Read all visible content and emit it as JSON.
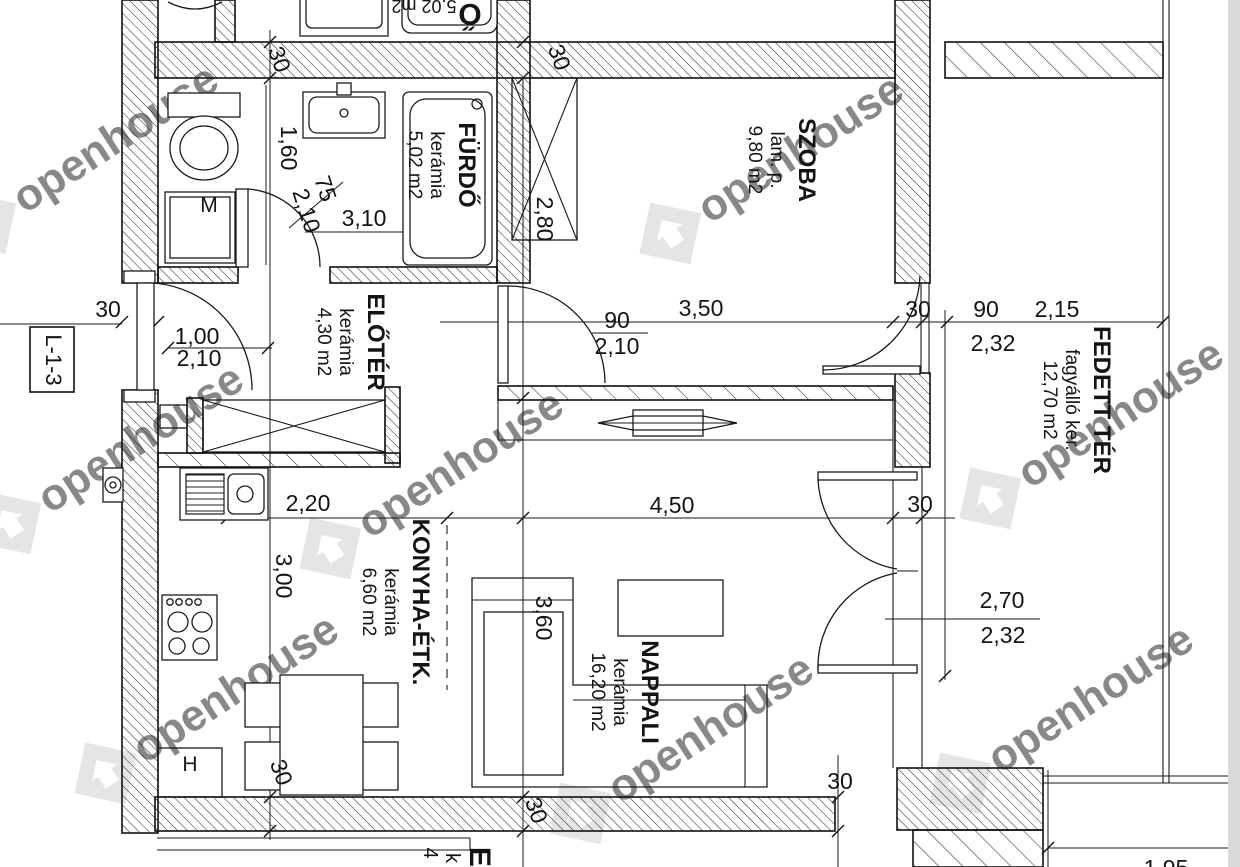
{
  "page": {
    "background": "#ffffff",
    "line_color": "#1a1a1a",
    "watermark_color": "#cccccc",
    "edge_strip_color": "#d9d9d9"
  },
  "title_box": {
    "code": "L-1-3"
  },
  "watermark": {
    "text": "openhouse",
    "positions": [
      [
        110,
        140
      ],
      [
        795,
        150
      ],
      [
        1115,
        415
      ],
      [
        135,
        440
      ],
      [
        455,
        465
      ],
      [
        230,
        690
      ],
      [
        705,
        730
      ],
      [
        1085,
        700
      ]
    ]
  },
  "rooms": [
    {
      "name": "FÜRDŐ",
      "material": "kerámia",
      "area": "5,02 m2",
      "cx": 459,
      "cy": 165
    },
    {
      "name": "SZOBA",
      "material": "lam. p.",
      "area": "9,80 m2",
      "cx": 799,
      "cy": 160
    },
    {
      "name": "ELŐTÉR",
      "material": "kerámia",
      "area": "4,30 m2",
      "cx": 368,
      "cy": 342
    },
    {
      "name": "KONYHA-ÉTK.",
      "material": "kerámia",
      "area": "6,60 m2",
      "cx": 413,
      "cy": 602
    },
    {
      "name": "NAPPALI",
      "material": "kerámia",
      "area": "16,20 m2",
      "cx": 642,
      "cy": 692
    },
    {
      "name": "FEDETT TÉR",
      "material": "fagyálló ker.",
      "area": "12,70 m2",
      "cx": 1094,
      "cy": 400
    }
  ],
  "appliances": [
    {
      "label": "M",
      "x": 209,
      "y": 212
    },
    {
      "label": "H",
      "x": 190,
      "y": 771
    }
  ],
  "dimensions": [
    {
      "t": "30",
      "x": 272,
      "y": 62,
      "rot": 70
    },
    {
      "t": "30",
      "x": 552,
      "y": 60,
      "rot": 70
    },
    {
      "t": "1,60",
      "x": 281,
      "y": 148,
      "rot": 90
    },
    {
      "t": "75",
      "x": 318,
      "y": 191,
      "rot": 72
    },
    {
      "t": "2,10",
      "x": 299,
      "y": 213,
      "rot": 72
    },
    {
      "t": "3,10",
      "x": 364,
      "y": 226,
      "rot": 0
    },
    {
      "t": "2,80",
      "x": 537,
      "y": 219,
      "rot": 90
    },
    {
      "t": "30",
      "x": 108,
      "y": 317,
      "rot": 0
    },
    {
      "t": "1,00",
      "x": 197,
      "y": 344,
      "rot": 0
    },
    {
      "t": "2,10",
      "x": 199,
      "y": 366,
      "rot": 0
    },
    {
      "t": "3,50",
      "x": 701,
      "y": 316,
      "rot": 0
    },
    {
      "t": "90",
      "x": 617,
      "y": 328,
      "rot": 0
    },
    {
      "t": "2,10",
      "x": 617,
      "y": 354,
      "rot": 0
    },
    {
      "t": "30",
      "x": 918,
      "y": 317,
      "rot": 0
    },
    {
      "t": "90",
      "x": 986,
      "y": 317,
      "rot": 0
    },
    {
      "t": "2,15",
      "x": 1057,
      "y": 317,
      "rot": 0
    },
    {
      "t": "2,32",
      "x": 993,
      "y": 351,
      "rot": 0
    },
    {
      "t": "2,20",
      "x": 308,
      "y": 511,
      "rot": 0
    },
    {
      "t": "4,50",
      "x": 672,
      "y": 513,
      "rot": 0
    },
    {
      "t": "30",
      "x": 920,
      "y": 512,
      "rot": 0
    },
    {
      "t": "3,00",
      "x": 276,
      "y": 576,
      "rot": 90
    },
    {
      "t": "3,60",
      "x": 536,
      "y": 618,
      "rot": 90
    },
    {
      "t": "2,70",
      "x": 1002,
      "y": 608,
      "rot": 0
    },
    {
      "t": "2,32",
      "x": 1003,
      "y": 643,
      "rot": 0
    },
    {
      "t": "30",
      "x": 840,
      "y": 789,
      "rot": 0
    },
    {
      "t": "30",
      "x": 274,
      "y": 775,
      "rot": 70
    },
    {
      "t": "30",
      "x": 529,
      "y": 813,
      "rot": 70
    },
    {
      "t": "1,95",
      "x": 1166,
      "y": 876,
      "rot": 0
    }
  ],
  "edge_fragments": [
    {
      "t": "Ő",
      "x": 470,
      "y": 4,
      "rot": 180,
      "size": 30,
      "bold": true
    },
    {
      "t": "5,02 m2",
      "x": 424,
      "y": 0,
      "rot": 180,
      "size": 18,
      "bold": false
    },
    {
      "t": "El",
      "x": 470,
      "y": 861,
      "rot": 90,
      "size": 30,
      "bold": true
    },
    {
      "t": "k",
      "x": 446,
      "y": 858,
      "rot": 90,
      "size": 20,
      "bold": false
    },
    {
      "t": "4",
      "x": 424,
      "y": 853,
      "rot": 90,
      "size": 20,
      "bold": false
    }
  ]
}
